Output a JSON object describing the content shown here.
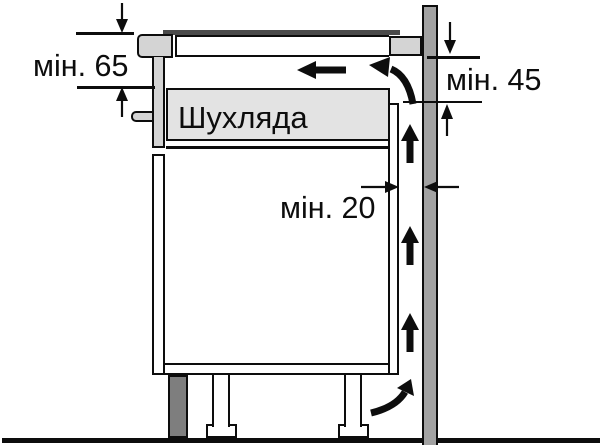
{
  "labels": {
    "min_top_clearance": "мін. 65",
    "min_back_clearance": "мін. 45",
    "min_wall_gap": "мін. 20",
    "drawer": "Шухляда"
  },
  "colors": {
    "background": "#ffffff",
    "outline": "#0d0d0d",
    "wall": "#a2a2a2",
    "cabinet_gray": "#d4d4d4",
    "drawer_fill": "#e3e3e3",
    "plinth": "#7e7e7e",
    "hob_glass": "#4a4a4a"
  }
}
